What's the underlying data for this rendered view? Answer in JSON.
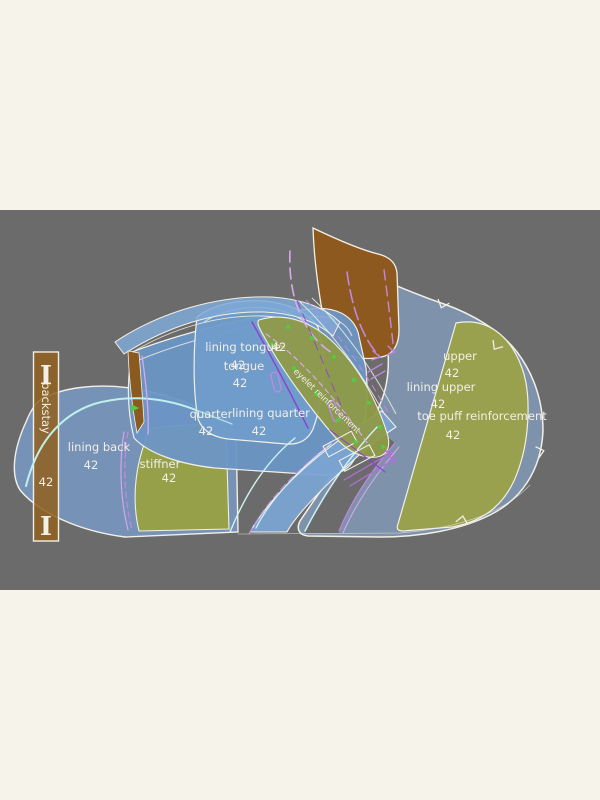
{
  "board": {
    "page_background": "#F5F3EA",
    "board_background": "#6B6B6B",
    "outline_color": "#F2EFE6"
  },
  "size": "42",
  "pieces": {
    "upper": {
      "label": "upper",
      "size": "42",
      "color": "#7E93AB"
    },
    "lining_upper": {
      "label": "lining upper",
      "size": "42"
    },
    "toe_puff": {
      "label": "toe puff reinforcement",
      "size": "42",
      "color": "#9AA14E"
    },
    "quarter": {
      "label": "quarter",
      "size": "42",
      "color": "#6C96C5"
    },
    "lining_quarter": {
      "label": "lining quarter",
      "size": "42"
    },
    "tongue": {
      "label": "tongue",
      "size": "42",
      "color": "#6F9CCB"
    },
    "lining_tongue": {
      "label": "lining tongue",
      "size": "42",
      "stray_size": "42"
    },
    "lining_back": {
      "label": "lining back",
      "size": "42",
      "color": "#7896BE"
    },
    "stiffner": {
      "label": "stiffner",
      "size": "42",
      "color": "#96A049"
    },
    "eyelet": {
      "label": "eyelet reinforcement",
      "color": "#8E9A48"
    },
    "backstay": {
      "label": "backstay",
      "size": "42",
      "color": "#90601F",
      "top_mark": "I",
      "bottom_mark": "I"
    },
    "heel_patch": {
      "color": "#8E591E"
    }
  },
  "accents": {
    "cyan_line": "#BFF0EC",
    "purple_line": "#C187E2",
    "lavender_line": "#D9A9EC",
    "violet_line": "#8F3FD0",
    "green_dot": "#55C944"
  }
}
